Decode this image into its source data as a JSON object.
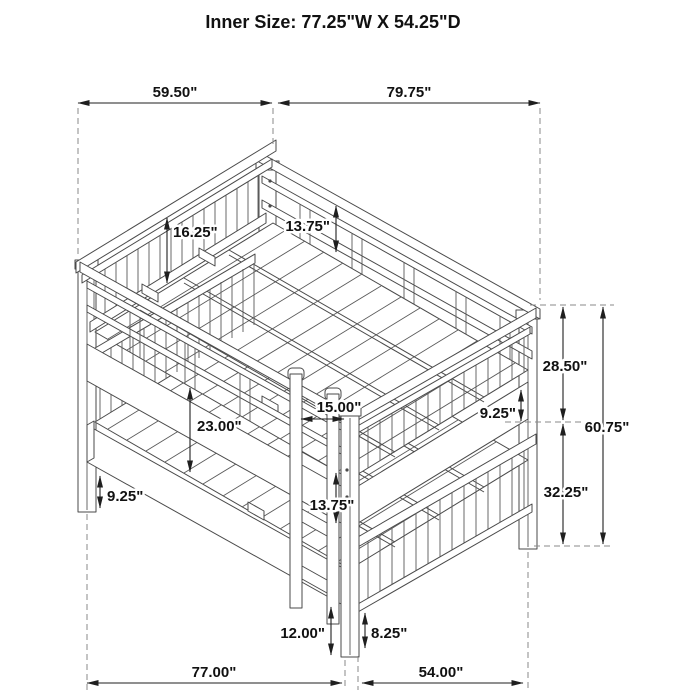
{
  "title": "Inner Size: 77.25\"W X 54.25\"D",
  "dims": {
    "upper_left_span": "59.50\"",
    "upper_right_span": "79.75\"",
    "guardrail_height": "16.25\"",
    "back_rail_height": "13.75\"",
    "upper_section_height": "28.50\"",
    "total_height": "60.75\"",
    "upper_side_rail_height": "9.25\"",
    "lower_section_height": "32.25\"",
    "bunk_clearance": "23.00\"",
    "ladder_width": "15.00\"",
    "ladder_rung_spacing": "13.75\"",
    "lower_leg_height": "9.25\"",
    "lower_rail_floor_clearance": "12.00\"",
    "footboard_floor_clearance": "8.25\"",
    "floor_length": "77.00\"",
    "floor_depth": "54.00\""
  }
}
